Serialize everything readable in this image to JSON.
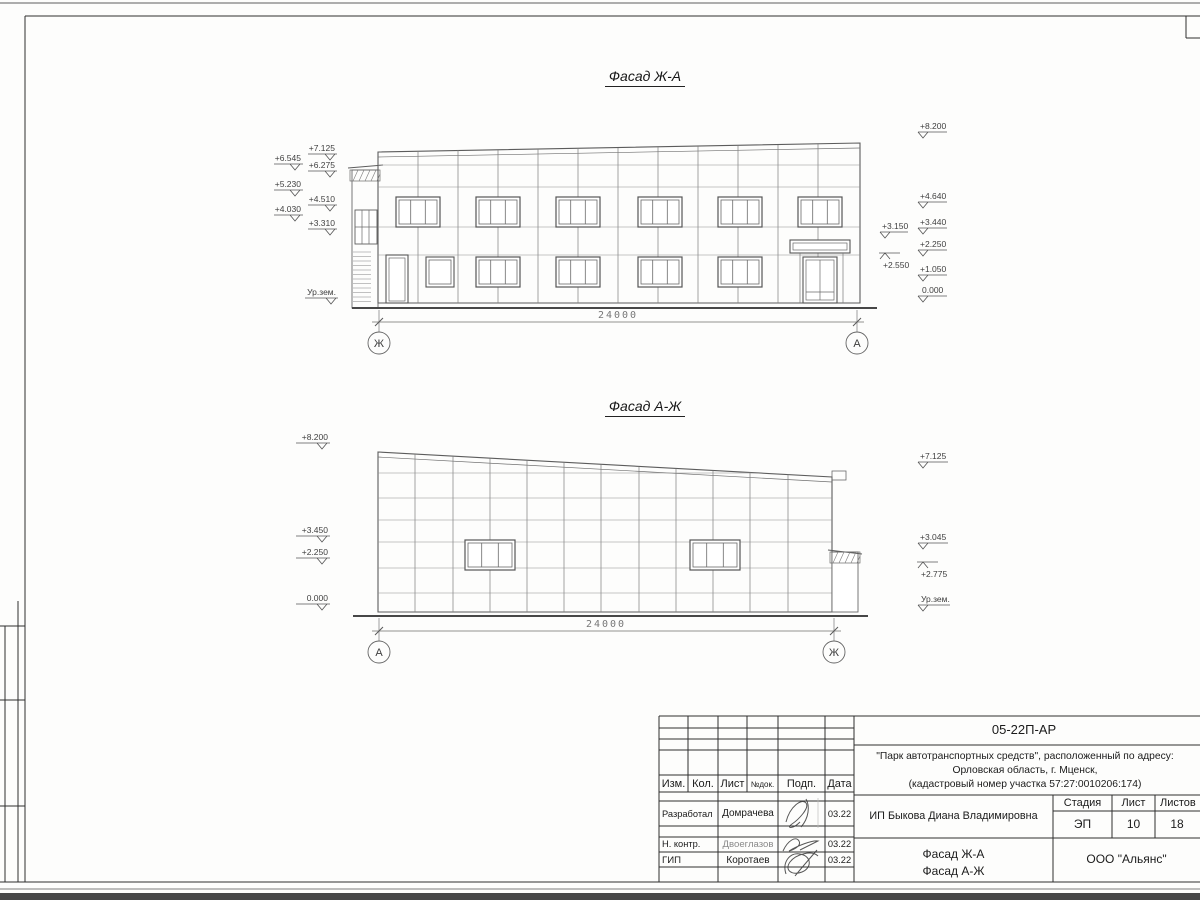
{
  "facade1": {
    "title": "Фасад Ж-А",
    "dimension": "24000",
    "axis_left": "Ж",
    "axis_right": "А",
    "marks_left": [
      "+7.125",
      "+6.545",
      "+6.275",
      "+5.230",
      "+4.510",
      "+4.030",
      "+3.310",
      "Ур.зем."
    ],
    "marks_right": [
      "+8.200",
      "+4.640",
      "+3.440",
      "+3.150",
      "+2.250",
      "+2.550",
      "+1.050",
      "0.000"
    ]
  },
  "facade2": {
    "title": "Фасад А-Ж",
    "dimension": "24000",
    "axis_left": "А",
    "axis_right": "Ж",
    "marks_left": [
      "+8.200",
      "+3.450",
      "+2.250",
      "0.000"
    ],
    "marks_right": [
      "+7.125",
      "+3.045",
      "+2.775",
      "Ур.зем."
    ]
  },
  "title_block": {
    "doc_code": "05-22П-АР",
    "project_line1": "\"Парк автотранспортных средств\",  расположенный по адресу:",
    "project_line2": "Орловская область, г. Мценск,",
    "project_line3": "(кадастровый номер участка 57:27:0010206:174)",
    "col_izm": "Изм.",
    "col_kol": "Кол.",
    "col_list": "Лист",
    "col_ndok": "№док.",
    "col_podp": "Подп.",
    "col_data": "Дата",
    "row1_role": "Разработал",
    "row1_name": "Домрачева",
    "row1_date": "03.22",
    "row2_role": "Н. контр.",
    "row2_name": "Двоеглазов",
    "row2_date": "03.22",
    "row3_role": "ГИП",
    "row3_name": "Коротаев",
    "row3_date": "03.22",
    "client": "ИП Быкова Диана Владимировна",
    "stage_label": "Стадия",
    "sheet_label": "Лист",
    "sheets_label": "Листов",
    "stage": "ЭП",
    "sheet": "10",
    "sheets": "18",
    "sheet_title_line1": "Фасад Ж-А",
    "sheet_title_line2": "Фасад А-Ж",
    "company": "ООО \"Альянс\""
  }
}
